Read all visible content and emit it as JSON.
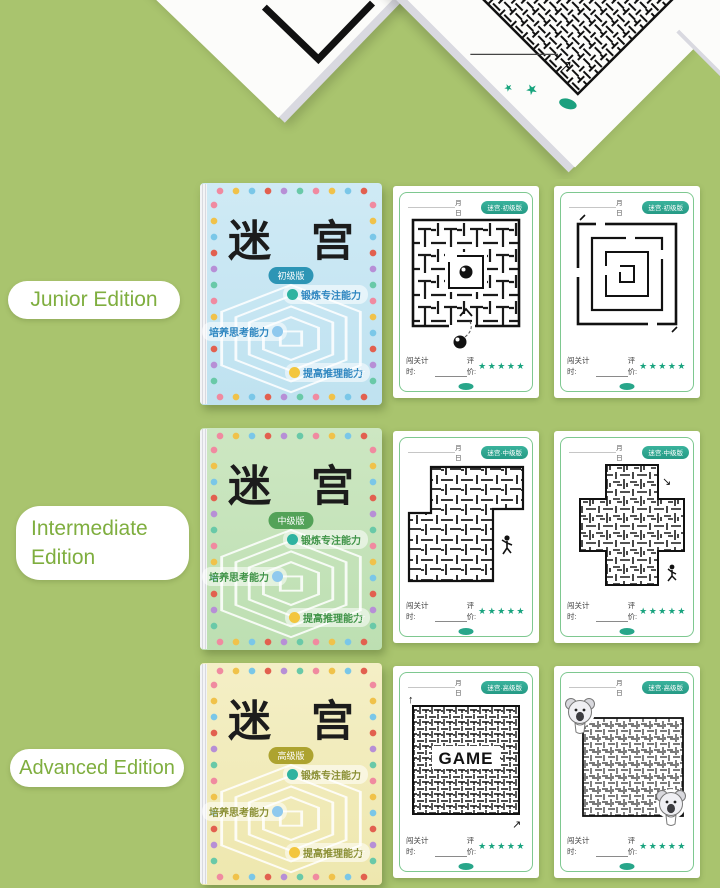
{
  "colors": {
    "background": "#a9c46e",
    "label_text_green": "#7fae3f",
    "star_teal": "#18a37e",
    "cover_junior_bg": "#c6e6f3",
    "cover_intermediate_bg": "#c5e3ba",
    "cover_advanced_bg": "#f2ecba",
    "badge_junior": "#2d95b5",
    "badge_intermediate": "#53a258",
    "badge_advanced": "#ada32f"
  },
  "banner": {
    "star_glyph": "★",
    "arrow_up_glyph": "↑"
  },
  "doodles": {
    "star": "☆"
  },
  "rows": [
    {
      "edition_label": "Junior Edition",
      "cover": {
        "title": "迷 宫",
        "edition_badge": "初级版",
        "features": [
          {
            "text": "锻炼专注能力"
          },
          {
            "text": "培养思考能力"
          },
          {
            "text": "提高推理能力"
          }
        ]
      },
      "pages": [
        {
          "date_text": "月　日",
          "badge": "迷宫·初级版",
          "timer_label": "闯关计时:",
          "rating_label": "评价:",
          "stars": "★★★★★"
        },
        {
          "date_text": "月　日",
          "badge": "迷宫·初级版",
          "timer_label": "闯关计时:",
          "rating_label": "评价:",
          "stars": "★★★★★"
        }
      ]
    },
    {
      "edition_label": "Intermediate Edition",
      "cover": {
        "title": "迷 宫",
        "edition_badge": "中级版",
        "features": [
          {
            "text": "锻炼专注能力"
          },
          {
            "text": "培养思考能力"
          },
          {
            "text": "提高推理能力"
          }
        ]
      },
      "pages": [
        {
          "date_text": "月　日",
          "badge": "迷宫·中级版",
          "timer_label": "闯关计时:",
          "rating_label": "评价:",
          "stars": "★★★★★",
          "arrow_glyph": "↘"
        },
        {
          "date_text": "月　日",
          "badge": "迷宫·中级版",
          "timer_label": "闯关计时:",
          "rating_label": "评价:",
          "stars": "★★★★★",
          "arrow_glyph": "↘"
        }
      ]
    },
    {
      "edition_label": "Advanced Edition",
      "cover": {
        "title": "迷 宫",
        "edition_badge": "高级版",
        "features": [
          {
            "text": "锻炼专注能力"
          },
          {
            "text": "培养思考能力"
          },
          {
            "text": "提高推理能力"
          }
        ]
      },
      "pages": [
        {
          "date_text": "月　日",
          "badge": "迷宫·高级版",
          "timer_label": "闯关计时:",
          "rating_label": "评价:",
          "stars": "★★★★★",
          "maze_text": "GAME",
          "arrow_up": "↑",
          "arrow_ne": "↗"
        },
        {
          "date_text": "月　日",
          "badge": "迷宫·高级版",
          "timer_label": "闯关计时:",
          "rating_label": "评价:",
          "stars": "★★★★★"
        }
      ]
    }
  ]
}
